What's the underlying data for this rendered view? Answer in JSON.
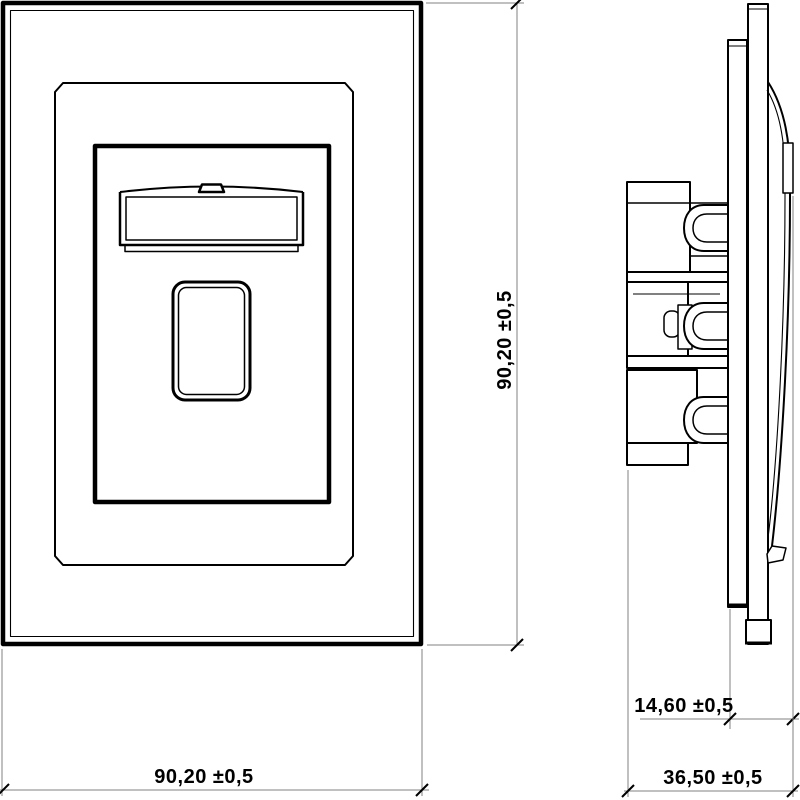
{
  "page": {
    "background": "#ffffff"
  },
  "drawing": {
    "stroke_color": "#000000",
    "dimension_line_color": "#808080"
  },
  "dims": {
    "front_height": {
      "text": "90,20 ±0,5"
    },
    "front_width": {
      "text": "90,20 ±0,5"
    },
    "side_protrusion": {
      "text": "14,60 ±0,5"
    },
    "side_depth": {
      "text": "36,50 ±0,5"
    }
  }
}
